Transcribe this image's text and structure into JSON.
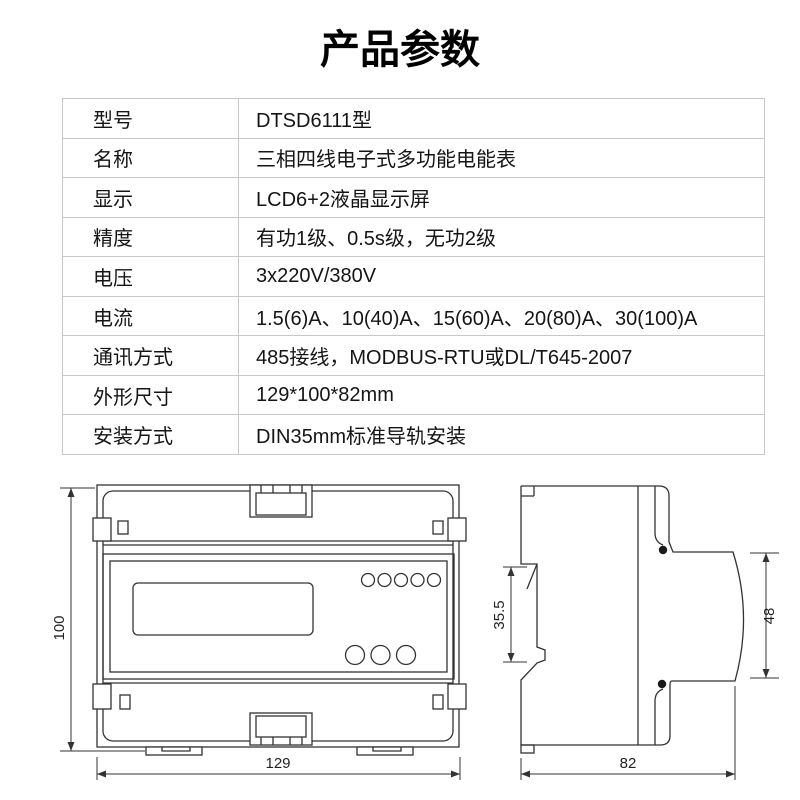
{
  "header": {
    "title": "产品参数"
  },
  "spec_table": {
    "rows": [
      {
        "label": "型号",
        "value": "DTSD6111型"
      },
      {
        "label": "名称",
        "value": "三相四线电子式多功能电能表"
      },
      {
        "label": "显示",
        "value": "LCD6+2液晶显示屏"
      },
      {
        "label": "精度",
        "value": "有功1级、0.5s级，无功2级"
      },
      {
        "label": "电压",
        "value": "3x220V/380V"
      },
      {
        "label": "电流",
        "value": "1.5(6)A、10(40)A、15(60)A、20(80)A、30(100)A"
      },
      {
        "label": "通讯方式",
        "value": "485接线，MODBUS-RTU或DL/T645-2007"
      },
      {
        "label": "外形尺寸",
        "value": "129*100*82mm"
      },
      {
        "label": "安装方式",
        "value": "DIN35mm标准导轨安装"
      }
    ]
  },
  "drawings": {
    "front_view": {
      "height_dim": "100",
      "width_dim": "129"
    },
    "side_view": {
      "rail_height_dim": "35.5",
      "face_height_dim": "48",
      "depth_dim": "82"
    }
  },
  "colors": {
    "drawing_line": "#333333",
    "table_border": "#c8c8c8",
    "text": "#111111"
  }
}
